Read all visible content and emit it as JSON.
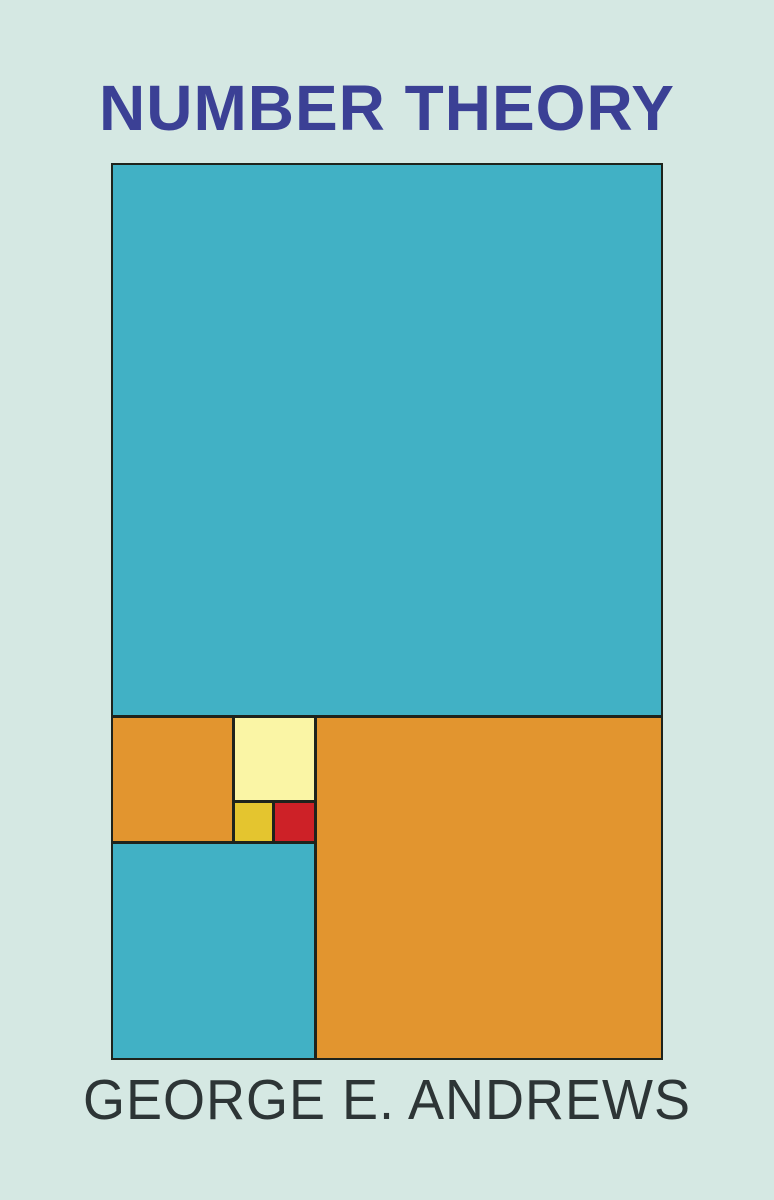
{
  "cover": {
    "title": "NUMBER THEORY",
    "author": "GEORGE E. ANDREWS",
    "colors": {
      "background": "#d5e8e3",
      "title_text": "#3b4095",
      "author_text": "#2d3536",
      "outline": "#1e231c",
      "teal": "#41b1c5",
      "orange": "#e2952f",
      "cream": "#faf5a5",
      "yellow": "#e4c52f",
      "red": "#cd2127"
    },
    "figure": {
      "description": "Golden rectangle subdivided into Fibonacci squares",
      "squares": [
        {
          "name": "large-teal-square",
          "color": "teal"
        },
        {
          "name": "small-orange-square",
          "color": "orange"
        },
        {
          "name": "cream-square",
          "color": "cream"
        },
        {
          "name": "yellow-tiny-square",
          "color": "yellow"
        },
        {
          "name": "red-tiny-square",
          "color": "red"
        },
        {
          "name": "large-orange-square",
          "color": "orange"
        },
        {
          "name": "bottom-cyan-square",
          "color": "teal"
        }
      ]
    }
  }
}
